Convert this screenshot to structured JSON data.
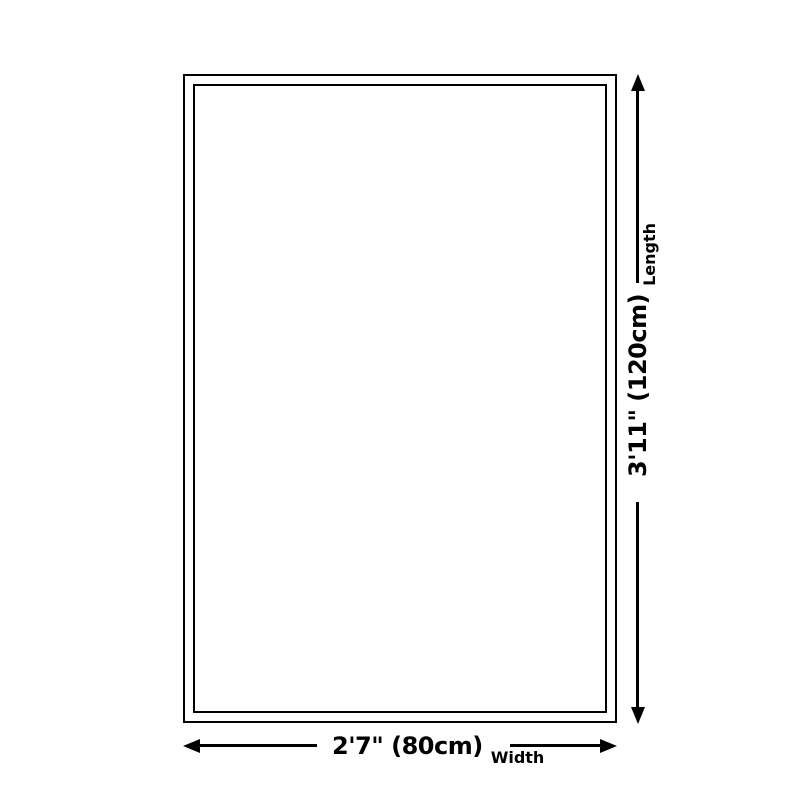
{
  "diagram": {
    "type": "product-dimension-diagram",
    "colors": {
      "line": "#000000",
      "background": "#ffffff"
    },
    "length_dim": {
      "value": "3'11\" (120cm)",
      "label": "Length"
    },
    "width_dim": {
      "value": "2'7\" (80cm)",
      "label": "Width"
    }
  }
}
